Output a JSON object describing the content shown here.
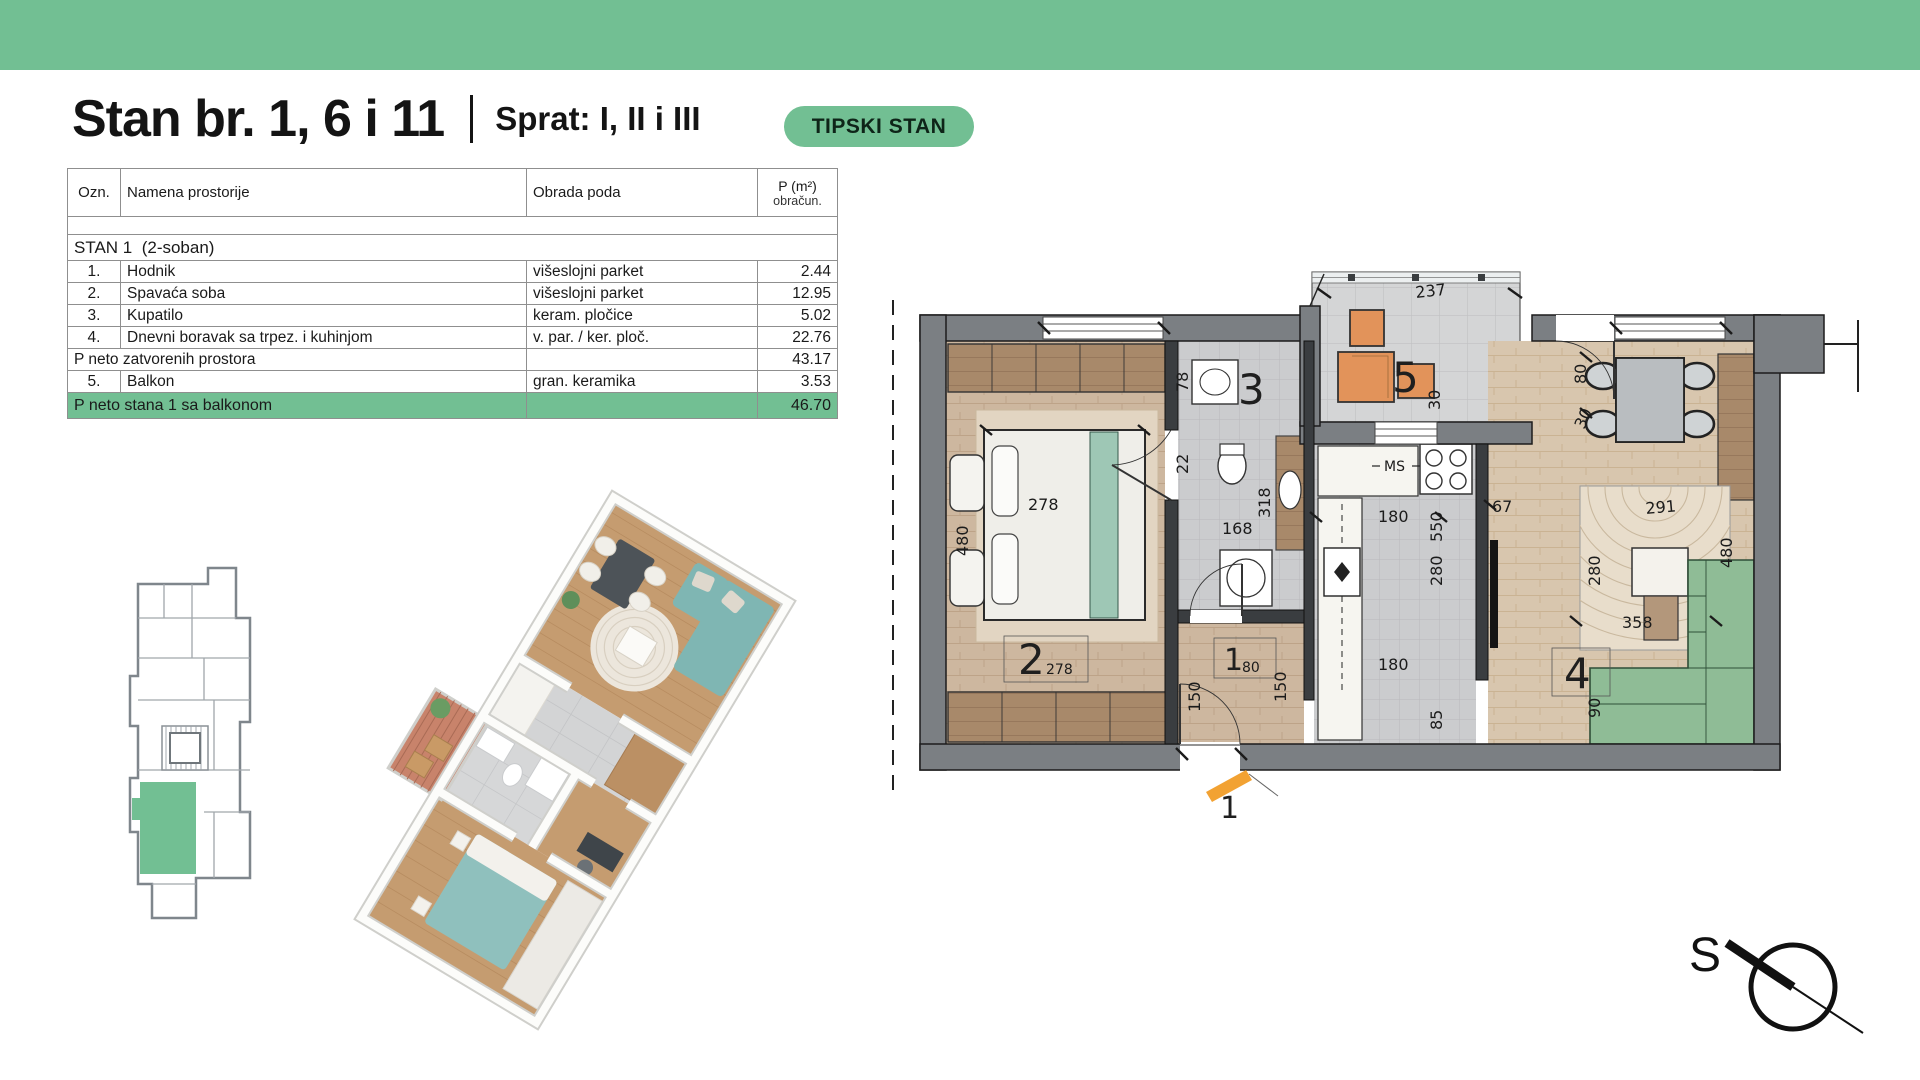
{
  "title": {
    "main": "Stan br. 1, 6 i 11",
    "separator": "|",
    "sub": "Sprat: I, II i III",
    "badge": "TIPSKI STAN"
  },
  "table": {
    "col_ozn": "Ozn.",
    "col_namena": "Namena prostorije",
    "col_obrada": "Obrada poda",
    "col_p_line1": "P (m²)",
    "col_p_line2": "obračun.",
    "section": "STAN 1  (2-soban)",
    "rows": [
      {
        "ozn": "1.",
        "namena": "Hodnik",
        "obrada": "višeslojni parket",
        "p": "2.44"
      },
      {
        "ozn": "2.",
        "namena": "Spavaća soba",
        "obrada": "višeslojni parket",
        "p": "12.95"
      },
      {
        "ozn": "3.",
        "namena": "Kupatilo",
        "obrada": "keram. pločice",
        "p": "5.02"
      },
      {
        "ozn": "4.",
        "namena": "Dnevni boravak sa trpez. i kuhinjom",
        "obrada": "v. par. / ker. ploč.",
        "p": "22.76"
      }
    ],
    "subtotal_label": "P neto zatvorenih prostora",
    "subtotal_value": "43.17",
    "balcony_row": {
      "ozn": "5.",
      "namena": "Balkon",
      "obrada": "gran. keramika",
      "p": "3.53"
    },
    "total_label": "P neto stana 1 sa balkonom",
    "total_value": "46.70"
  },
  "plan": {
    "room_numbers": {
      "hodnik": "1",
      "spavaca_soba": "2",
      "kupatilo": "3",
      "dnevni_boravak": "4",
      "balkon": "5"
    },
    "room_sub_dims": {
      "spavaca": "278",
      "hodnik": "80"
    },
    "dims": {
      "balcony_width": "237",
      "balcony_side": "30",
      "living_door": "80",
      "living_door_side": "30",
      "bed_width": "278",
      "bed_length": "480",
      "bath_sink": "78",
      "bath_gap": "22",
      "bath_depth": "318",
      "bath_width": "168",
      "hall_left": "150",
      "hall_right": "150",
      "kitchen_top": "180",
      "kitchen_len1": "550",
      "kitchen_len2": "280",
      "kitchen_bottom": "180",
      "hall_bottom": "85",
      "living_gap": "67",
      "rug_width": "291",
      "rug_depth": "280",
      "sofa_side": "480",
      "living_width": "358",
      "living_niche": "90"
    },
    "kitchen_label": "MS",
    "entry_label": "1"
  },
  "compass": {
    "north_label": "S"
  },
  "colors": {
    "accent_green": "#72BF93",
    "balcony_furniture_orange": "#E2935A",
    "sofa_green": "#8FBC96",
    "bed_teal": "#8FC0BD",
    "wall_gray": "#7B7F83"
  }
}
